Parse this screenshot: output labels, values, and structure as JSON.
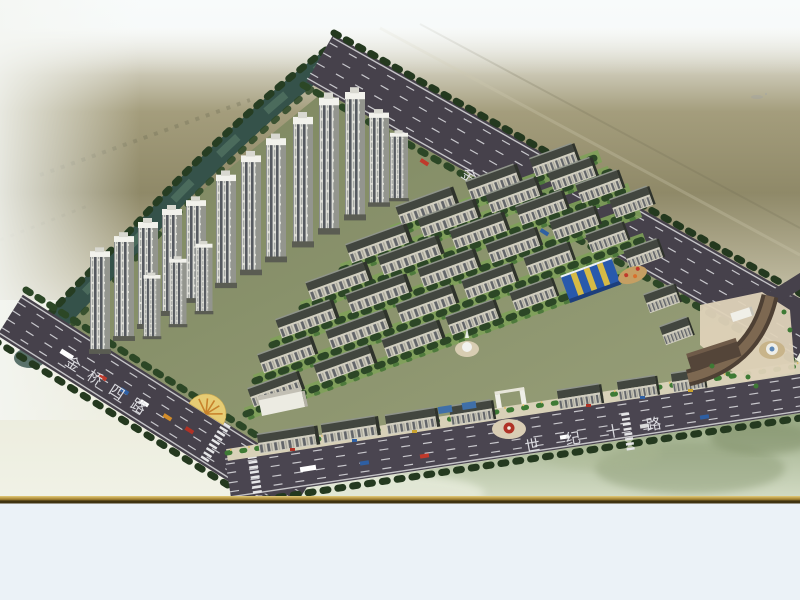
{
  "scene": {
    "kind": "aerial-masterplan-rendering-photo",
    "roads": {
      "top_right_label": "金桥五路",
      "left_label": "金桥四路",
      "bottom_label": "世纪十路"
    },
    "colors": {
      "sky_white": "#f5f8f7",
      "ground_olive": "#928c6b",
      "river_water": "#35524a",
      "road_asphalt": "#46414b",
      "lane_marking": "#d8d8dc",
      "road_label_text": "#e3e4e8",
      "site_green": "#80885f",
      "tree_dark_green": "#2c4726",
      "lawn_green": "#7fa159",
      "building_roof": "#42463f",
      "building_facade": "#d2cfc1",
      "tower_stripe": "#585c60",
      "kindergarten_blue": "#2859ac",
      "kindergarten_yellow": "#e5c23c",
      "plaza_paving": "#ded2b8",
      "fountain_white": "#f2f2ee",
      "frame_gold": "#b79a3f",
      "mat_blue_white": "#ebf2f7"
    }
  }
}
